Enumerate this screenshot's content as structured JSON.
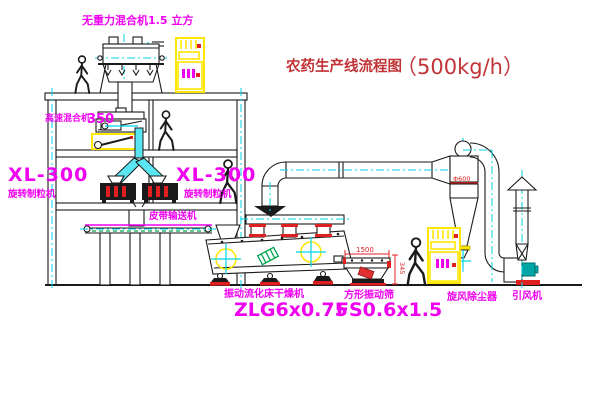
{
  "diagram": {
    "title": {
      "main": "农药生产线流程图",
      "capacity": "（500kg/h）"
    },
    "labels": {
      "gravity_mixer": "无重力混合机1.5 立方",
      "mixer350_name": "高速混合机",
      "mixer350_value": "350",
      "granulator_left_model": "XL-300",
      "granulator_left_name": "旋转制粒机",
      "granulator_right_model": "XL-300",
      "granulator_right_name": "旋转制粒机",
      "belt_conveyor": "皮带输送机",
      "dryer_name": "振动流化床干燥机",
      "dryer_model": "ZLG6x0.75",
      "sieve_name": "方形振动筛",
      "sieve_model": "FS0.6x1.5",
      "cyclone": "旋风除尘器",
      "fan": "引风机"
    },
    "dimensions": {
      "cyclone_diameter": "Φ600",
      "sieve_length": "1500",
      "sieve_height": "345"
    },
    "colors": {
      "line_black": "#1a1a1a",
      "label_magenta": "#f000f0",
      "title_red": "#c13437",
      "accent_red": "#e02020",
      "centerline_cyan": "#00d5e5",
      "chute_cyan": "#59e6f2",
      "highlight_yellow": "#ffe600",
      "motor_green": "#00a550",
      "fan_teal": "#00a5a5"
    }
  }
}
